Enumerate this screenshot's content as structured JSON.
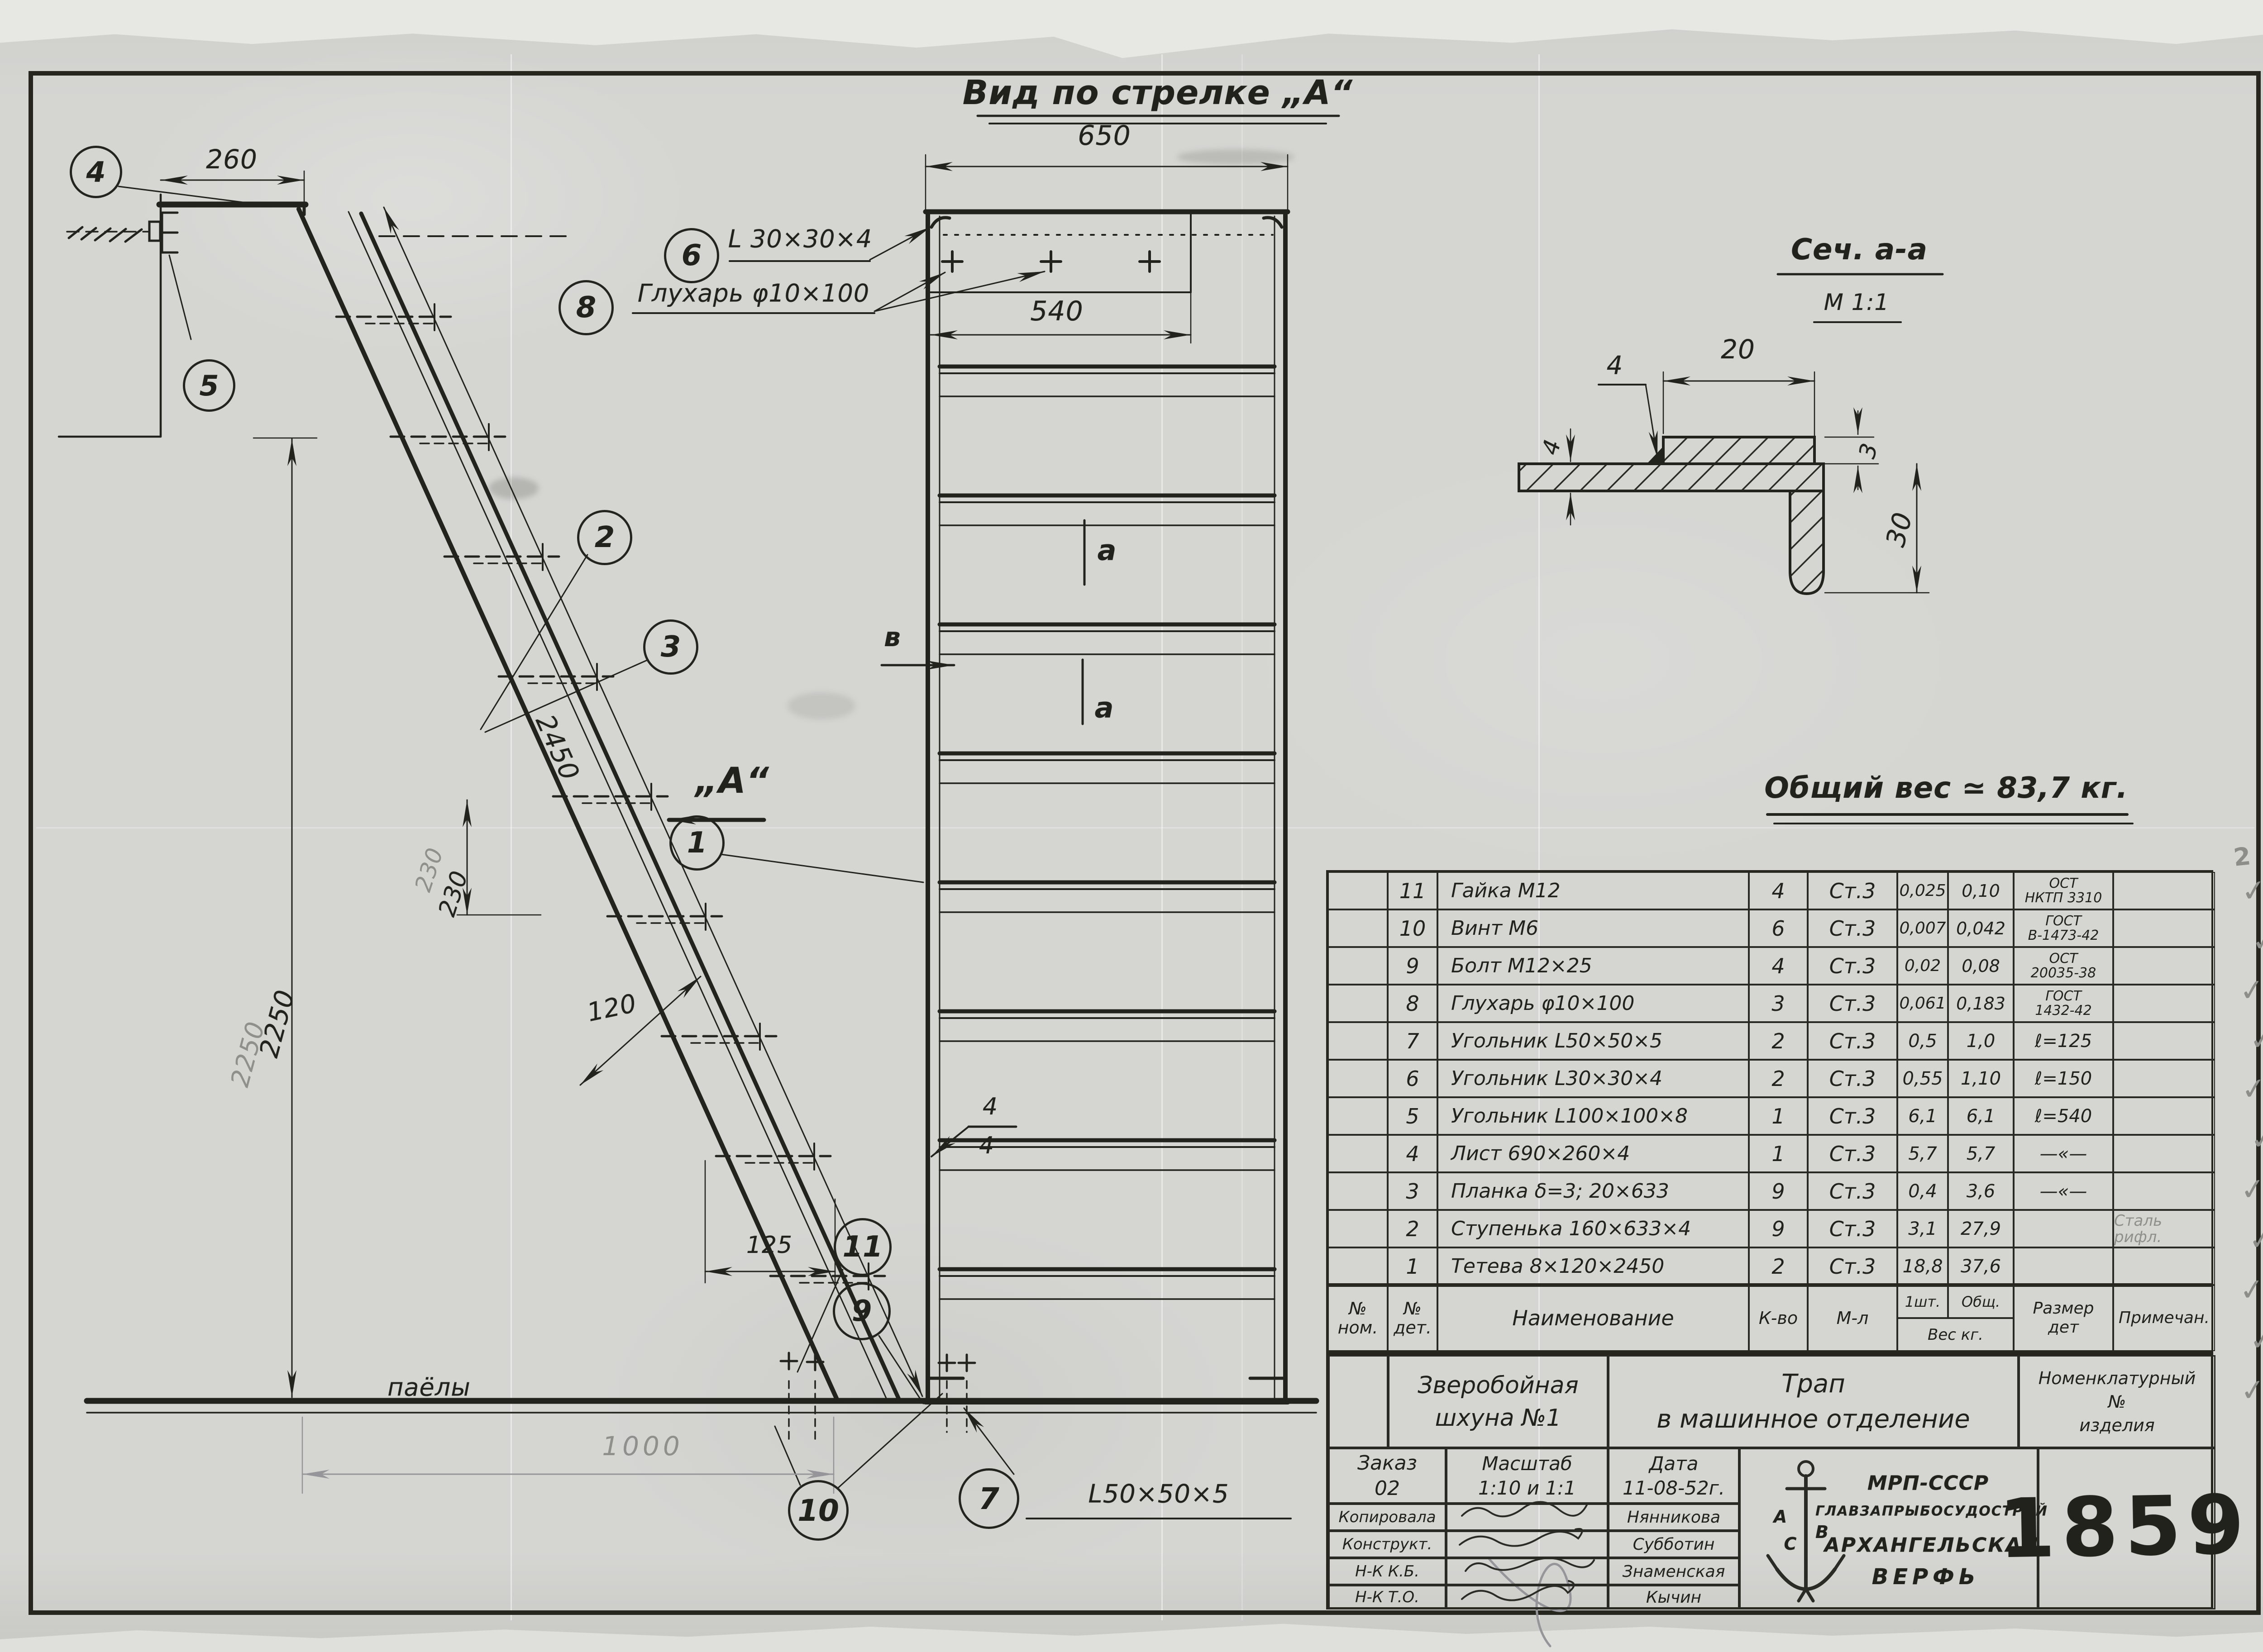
{
  "titles": {
    "view_a": "Вид по стрелке „А“",
    "section": "Сеч. а-а",
    "section_scale": "М 1:1",
    "total_weight": "Общий вес ≃ 83,7 кг."
  },
  "dims": {
    "d260": "260",
    "d650": "650",
    "d540": "540",
    "d2450": "2450",
    "d2250": "2250",
    "d230": "230",
    "d230_pencil": "230",
    "d120": "120",
    "d125": "125",
    "d1000": "1000",
    "d20": "20",
    "d30": "30",
    "d3": "3",
    "d4_left": "4",
    "d4_leader": "4",
    "weld_top": "4",
    "weld_bottom": "4"
  },
  "labels": {
    "floor": "паёлы",
    "view_arrow": "„А“",
    "mark_b": "в",
    "section_mark_1": "a",
    "section_mark_2": "a",
    "l6": "L 30×30×4",
    "l8": "Глухарь φ10×100",
    "l7": "L50×50×5"
  },
  "balloons": {
    "b1": "1",
    "b2": "2",
    "b3": "3",
    "b4": "4",
    "b5": "5",
    "b6": "6",
    "b7": "7",
    "b8": "8",
    "b9": "9",
    "b10": "10",
    "b11": "11"
  },
  "bom": {
    "headers": {
      "c1a": "№",
      "c1b": "ном.",
      "c2a": "№",
      "c2b": "дет.",
      "name": "Наименование",
      "qty": "К-во",
      "mat": "М-л",
      "w1": "1шт.",
      "w2": "Общ.",
      "w": "Вес кг.",
      "size_a": "Размер",
      "size_b": "дет",
      "note": "Примечан."
    },
    "rows": [
      {
        "num": "11",
        "name": "Гайка М12",
        "qty": "4",
        "mat": "Ст.3",
        "w1": "0,025",
        "w2": "0,10",
        "size1": "ОСТ",
        "size2": "НКТП 3310",
        "note": ""
      },
      {
        "num": "10",
        "name": "Винт М6",
        "qty": "6",
        "mat": "Ст.3",
        "w1": "0,007",
        "w2": "0,042",
        "size1": "ГОСТ",
        "size2": "В-1473-42",
        "note": ""
      },
      {
        "num": "9",
        "name": "Болт М12×25",
        "qty": "4",
        "mat": "Ст.3",
        "w1": "0,02",
        "w2": "0,08",
        "size1": "ОСТ",
        "size2": "20035-38",
        "note": ""
      },
      {
        "num": "8",
        "name": "Глухарь φ10×100",
        "qty": "3",
        "mat": "Ст.3",
        "w1": "0,061",
        "w2": "0,183",
        "size1": "ГОСТ",
        "size2": "1432-42",
        "note": ""
      },
      {
        "num": "7",
        "name": "Угольник L50×50×5",
        "qty": "2",
        "mat": "Ст.3",
        "w1": "0,5",
        "w2": "1,0",
        "size1": "ℓ=125",
        "size2": "",
        "note": ""
      },
      {
        "num": "6",
        "name": "Угольник L30×30×4",
        "qty": "2",
        "mat": "Ст.3",
        "w1": "0,55",
        "w2": "1,10",
        "size1": "ℓ=150",
        "size2": "",
        "note": ""
      },
      {
        "num": "5",
        "name": "Угольник L100×100×8",
        "qty": "1",
        "mat": "Ст.3",
        "w1": "6,1",
        "w2": "6,1",
        "size1": "ℓ=540",
        "size2": "",
        "note": ""
      },
      {
        "num": "4",
        "name": "Лист 690×260×4",
        "qty": "1",
        "mat": "Ст.3",
        "w1": "5,7",
        "w2": "5,7",
        "size1": "—«—",
        "size2": "",
        "note": ""
      },
      {
        "num": "3",
        "name": "Планка δ=3; 20×633",
        "qty": "9",
        "mat": "Ст.3",
        "w1": "0,4",
        "w2": "3,6",
        "size1": "—«—",
        "size2": "",
        "note": ""
      },
      {
        "num": "2",
        "name": "Ступенька 160×633×4",
        "qty": "9",
        "mat": "Ст.3",
        "w1": "3,1",
        "w2": "27,9",
        "size1": "",
        "size2": "",
        "note": "Сталь рифл."
      },
      {
        "num": "1",
        "name": "Тетева 8×120×2450",
        "qty": "2",
        "mat": "Ст.3",
        "w1": "18,8",
        "w2": "37,6",
        "size1": "",
        "size2": "",
        "note": ""
      }
    ]
  },
  "title_block": {
    "project1": "Зверобойная",
    "project2": "шхуна №1",
    "title1": "Трап",
    "title2": "в машинное отделение",
    "nom1": "Номенклатурный",
    "nom2": "№",
    "nom3": "изделия",
    "order_label": "Заказ",
    "order_value": "02",
    "scale_label": "Масштаб",
    "scale_value": "1:10 и 1:1",
    "date_label": "Дата",
    "date_value": "11-08-52г.",
    "sig_rows": [
      {
        "role": "Копировала",
        "name": "Нянникова"
      },
      {
        "role": "Конструкт.",
        "name": "Субботин"
      },
      {
        "role": "Н-К К.Б.",
        "name": "Знаменская"
      },
      {
        "role": "Н-К Т.О.",
        "name": "Кычин"
      }
    ],
    "org1": "МРП-СССР",
    "org2": "ГЛАВЗАПРЫБОСУДОСТРОЙ",
    "org3": "АРХАНГЕЛЬСКАЯ",
    "org4": "ВЕРФЬ",
    "logo_letters": [
      "А",
      "С",
      "В"
    ],
    "drawing_number": "1859"
  },
  "margin": {
    "checks": [
      "✓",
      "✓",
      "✓",
      "✓",
      "✓",
      "✓",
      "✓",
      "✓",
      "✓",
      "✓",
      "✓"
    ],
    "pencil_mark": "2"
  }
}
